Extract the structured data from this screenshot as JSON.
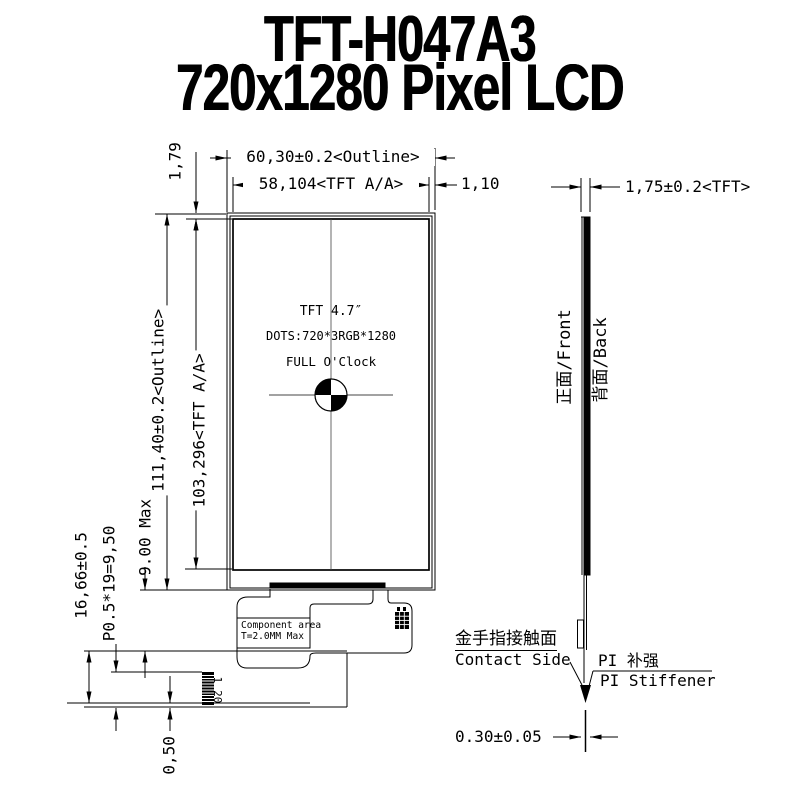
{
  "title": {
    "line1": "TFT-H047A3",
    "line2": "720x1280 Pixel LCD"
  },
  "front_view": {
    "dims": {
      "outline_width": "60,30±0.2<Outline>",
      "active_width": "58,104<TFT A/A>",
      "top_border": "1,79",
      "right_border": "1,10",
      "outline_height": "111,40±0.2<Outline>",
      "active_height": "103,296<TFT A/A>",
      "fpc_length": "16,66±0.5",
      "connector_pitch": "P0.5*19=9,50",
      "component_height": "9.00 Max",
      "tail_thickness": "0,50"
    },
    "panel_label": {
      "line1": "TFT 4.7″",
      "line2": "DOTS:720*3RGB*1280",
      "line3": "FULL O'Clock"
    },
    "component_area": {
      "line1": "Component area",
      "line2": "T=2.0MM Max"
    },
    "connector_pins": {
      "first": "1",
      "last": "20"
    }
  },
  "side_view": {
    "dims": {
      "tft_thickness": "1,75±0.2<TFT>",
      "fpc_thickness": "0.30±0.05"
    },
    "labels": {
      "front_cn_en": "正面/Front",
      "back_cn_en": "背面/Back",
      "contact_cn": "金手指接触面",
      "contact_en": "Contact Side",
      "stiffener_cn": "PI 补强",
      "stiffener_en": "PI Stiffener"
    }
  },
  "colors": {
    "ink": "#000000",
    "background": "#ffffff"
  }
}
